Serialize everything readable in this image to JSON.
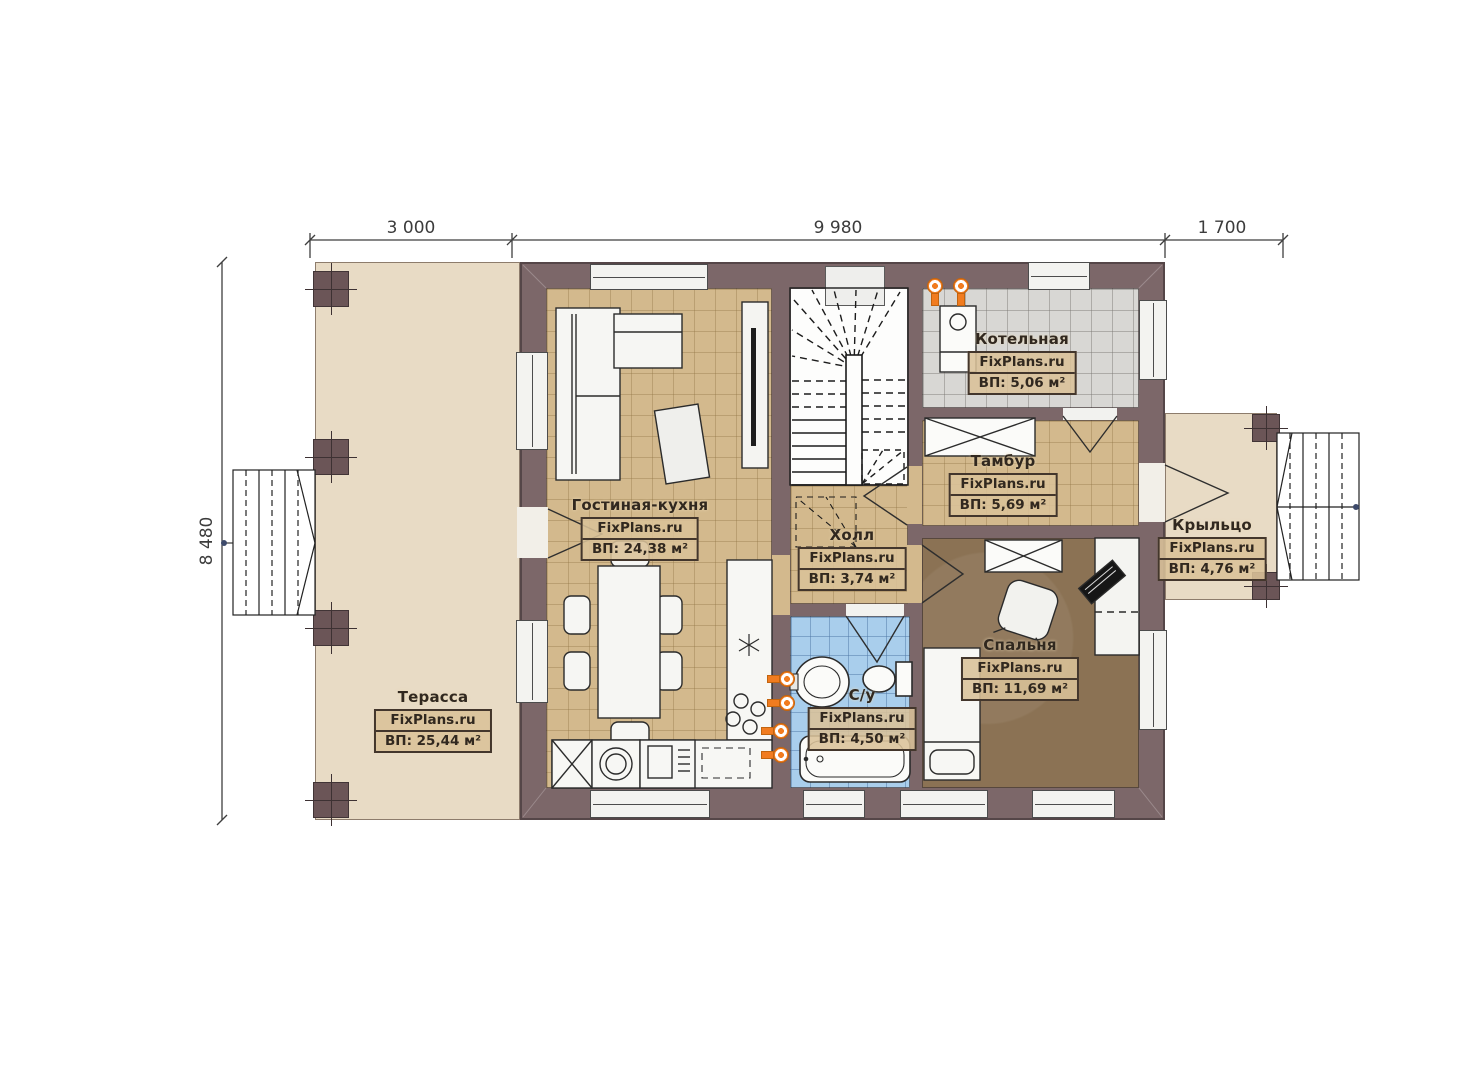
{
  "watermark": "FixPlans.ru",
  "dimensions": {
    "top": [
      "3 000",
      "9 980",
      "1 700"
    ],
    "left": "8 480"
  },
  "rooms": [
    {
      "name": "Терасса",
      "area": "ВП: 25,44 м²"
    },
    {
      "name": "Гостиная-кухня",
      "area": "ВП: 24,38 м²"
    },
    {
      "name": "Холл",
      "area": "ВП: 3,74 м²"
    },
    {
      "name": "Котельная",
      "area": "ВП: 5,06 м²"
    },
    {
      "name": "Тамбур",
      "area": "ВП: 5,69 м²"
    },
    {
      "name": "Спальня",
      "area": "ВП: 11,69 м²"
    },
    {
      "name": "С/у",
      "area": "ВП: 4,50 м²"
    },
    {
      "name": "Крыльцо",
      "area": "ВП: 4,76 м²"
    }
  ],
  "colors": {
    "wall": "#7c6769",
    "terrace_floor": "#e8dbc5",
    "tile_tan": "#d3b98d",
    "tile_grey": "#d8d7d4",
    "tile_blue": "#a9ceec",
    "bedroom_floor": "#8b7254",
    "heating_icon": "#f17c20",
    "label_box_bg": "#d9c298"
  }
}
